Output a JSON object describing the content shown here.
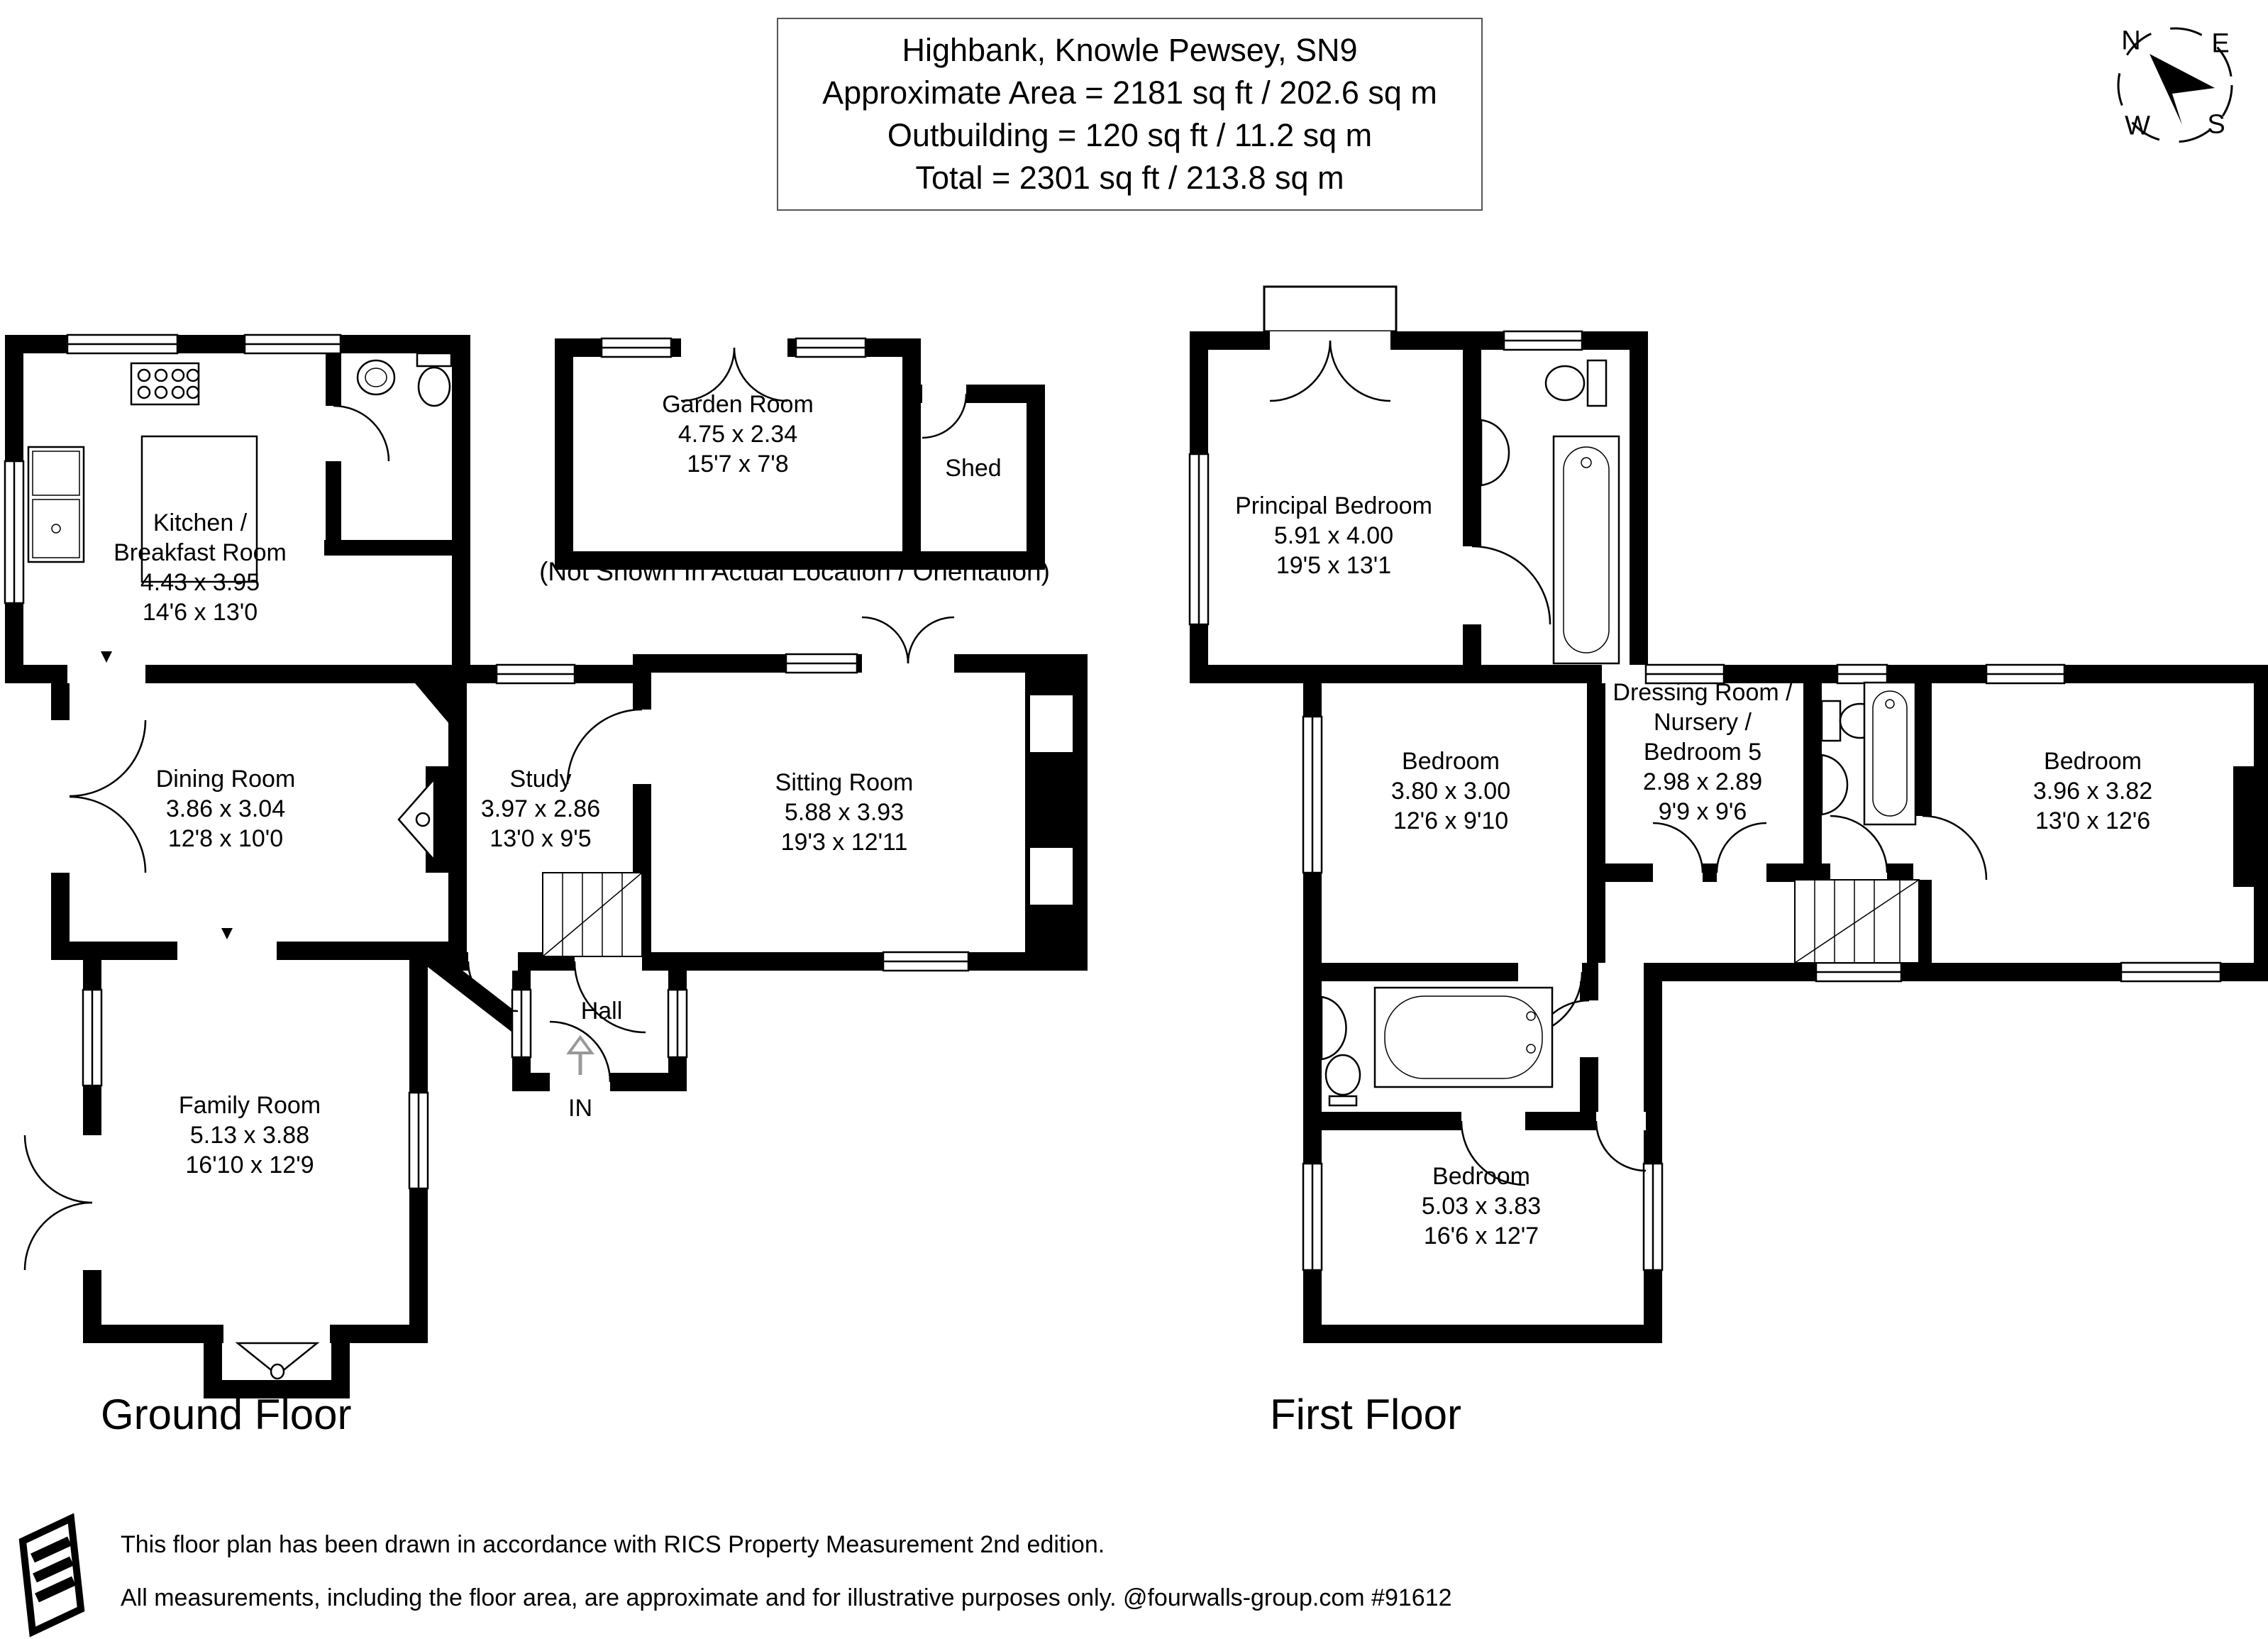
{
  "title_box": {
    "address": "Highbank, Knowle Pewsey, SN9",
    "area": "Approximate Area = 2181 sq ft / 202.6 sq m",
    "outbuilding": "Outbuilding = 120 sq ft / 11.2 sq m",
    "total": "Total = 2301 sq ft / 213.8 sq m"
  },
  "compass": {
    "north": "N",
    "east": "E",
    "south": "S",
    "west": "W"
  },
  "outbuilding_note": "(Not Shown In Actual Location / Orientation)",
  "floors": {
    "ground": {
      "label": "Ground Floor"
    },
    "first": {
      "label": "First Floor"
    }
  },
  "rooms": {
    "garden_room": {
      "name": "Garden Room",
      "metric": "4.75 x 2.34",
      "imperial": "15'7 x 7'8"
    },
    "shed": {
      "name": "Shed"
    },
    "kitchen": {
      "name": "Kitchen /",
      "name2": "Breakfast Room",
      "metric": "4.43 x 3.95",
      "imperial": "14'6 x 13'0"
    },
    "dining_room": {
      "name": "Dining Room",
      "metric": "3.86 x 3.04",
      "imperial": "12'8 x 10'0"
    },
    "study": {
      "name": "Study",
      "metric": "3.97 x 2.86",
      "imperial": "13'0 x 9'5"
    },
    "sitting_room": {
      "name": "Sitting Room",
      "metric": "5.88 x 3.93",
      "imperial": "19'3 x 12'11"
    },
    "hall": {
      "name": "Hall"
    },
    "entrance": {
      "label": "IN"
    },
    "family_room": {
      "name": "Family Room",
      "metric": "5.13 x 3.88",
      "imperial": "16'10 x 12'9"
    },
    "principal_bedroom": {
      "name": "Principal Bedroom",
      "metric": "5.91 x 4.00",
      "imperial": "19'5 x 13'1"
    },
    "bedroom_2": {
      "name": "Bedroom",
      "metric": "3.80 x 3.00",
      "imperial": "12'6 x 9'10"
    },
    "dressing_room": {
      "name": "Dressing Room /",
      "name2": "Nursery /",
      "name3": "Bedroom 5",
      "metric": "2.98 x 2.89",
      "imperial": "9'9 x 9'6"
    },
    "bedroom_4": {
      "name": "Bedroom",
      "metric": "3.96 x 3.82",
      "imperial": "13'0 x 12'6"
    },
    "bedroom_3": {
      "name": "Bedroom",
      "metric": "5.03 x 3.83",
      "imperial": "16'6 x 12'7"
    }
  },
  "footer": {
    "line1": "This floor plan has been drawn in accordance with RICS Property Measurement 2nd edition.",
    "line2": "All measurements, including the floor area, are approximate and for illustrative purposes only. @fourwalls-group.com #91612"
  }
}
